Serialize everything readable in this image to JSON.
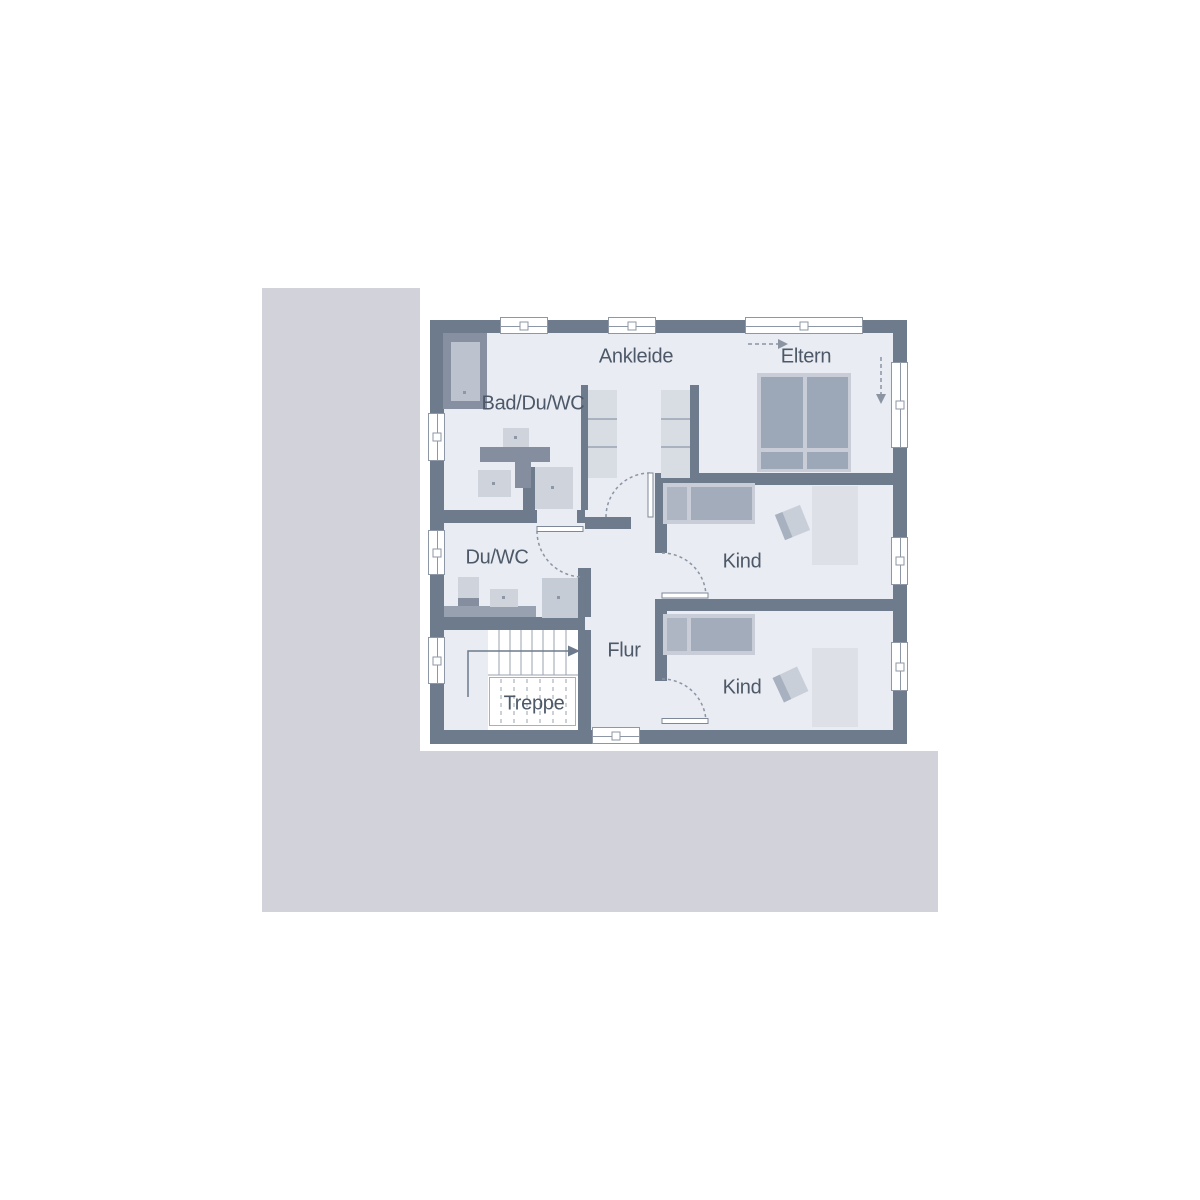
{
  "plan": {
    "type": "floorplan-upper-storey",
    "rooms": {
      "ankleide": {
        "label": "Ankleide"
      },
      "eltern": {
        "label": "Eltern"
      },
      "bad_du_wc": {
        "label": "Bad/Du/WC"
      },
      "du_wc": {
        "label": "Du/WC"
      },
      "kind_1": {
        "label": "Kind"
      },
      "kind_2": {
        "label": "Kind"
      },
      "flur": {
        "label": "Flur"
      },
      "treppe": {
        "label": "Treppe"
      }
    },
    "colors": {
      "wall": "#6e7b8c",
      "floor": "#e9ecf2",
      "site": "#d1d2da",
      "label": "#4d5968",
      "furniture_light": "#ced3dc",
      "furniture_medium": "#9ca7b7",
      "annotation_line": "#8a94a3"
    }
  }
}
